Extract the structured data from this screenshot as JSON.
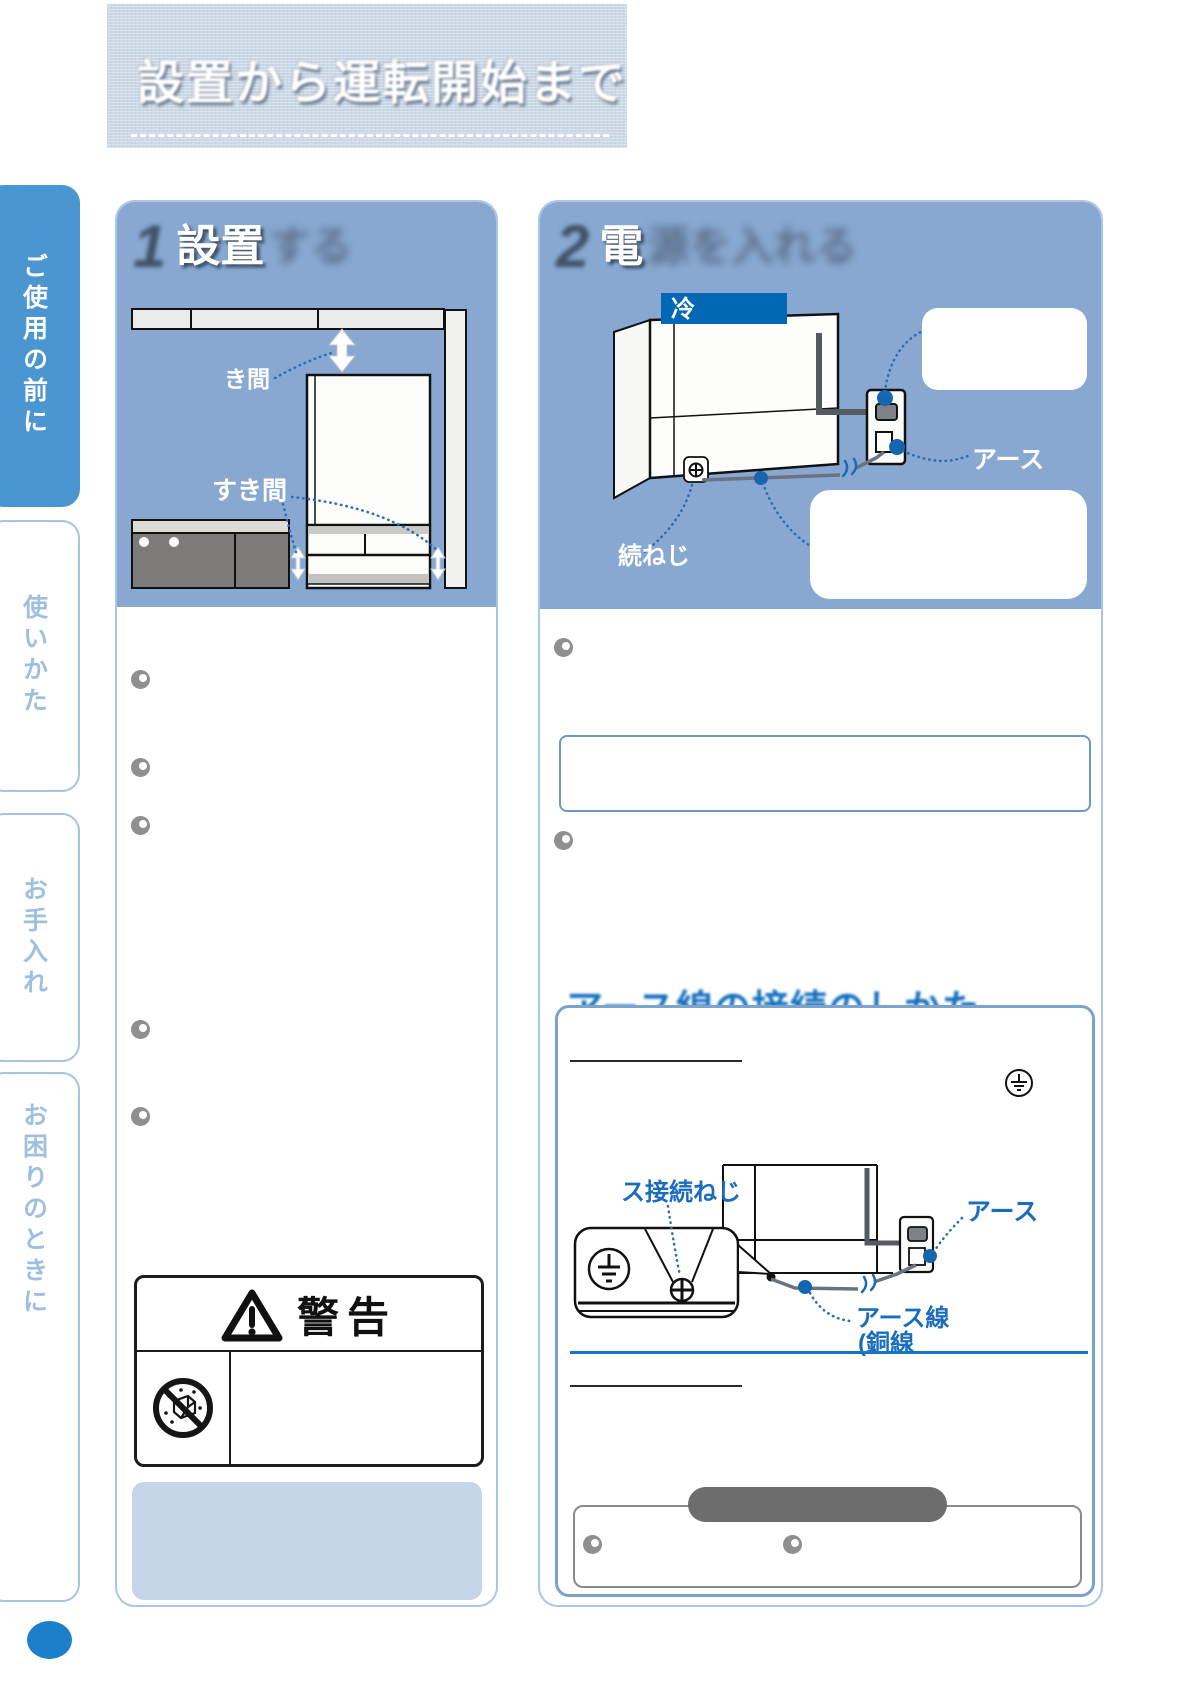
{
  "colors": {
    "band_blue": "#88a8d1",
    "tab_active_blue": "#4b95d1",
    "tab_text_blue": "#9fbfdf",
    "accent_blue": "#1470bd",
    "label_box_blue": "#0068b5",
    "page_circle_blue": "#1c7fc9",
    "leader_blue": "#2c6cb3",
    "divider_blue": "#1577c2",
    "soft_blue": "#c5d4e9",
    "pill_gray": "#6d6d6d"
  },
  "banner": {
    "title": "設置から運転開始まで"
  },
  "sidebar": {
    "tabs": [
      {
        "label": "ご使用の前に",
        "active": true
      },
      {
        "label": "使いかた",
        "active": false
      },
      {
        "label": "お手入れ",
        "active": false
      },
      {
        "label": "お困りのときに",
        "active": false
      }
    ]
  },
  "panel1": {
    "step_number": "1",
    "title_main": "設置",
    "title_blur": "する",
    "diagram": {
      "gap_top_label": "き間",
      "gap_side_label": "すき間"
    },
    "warning": {
      "title": "警告"
    }
  },
  "panel2": {
    "step_number": "2",
    "title_main": "電",
    "title_blur": "源を入れる",
    "diagram": {
      "fridge_label": "冷",
      "earth_label": "アース",
      "screw_label": "続ねじ"
    },
    "earth_section": {
      "heading": "アース線の接続のしかた",
      "diagram": {
        "screw_label": "ス接続ねじ",
        "earth_label": "アース",
        "wire_label": "アース線",
        "wire_label2": "(銅線"
      }
    }
  }
}
